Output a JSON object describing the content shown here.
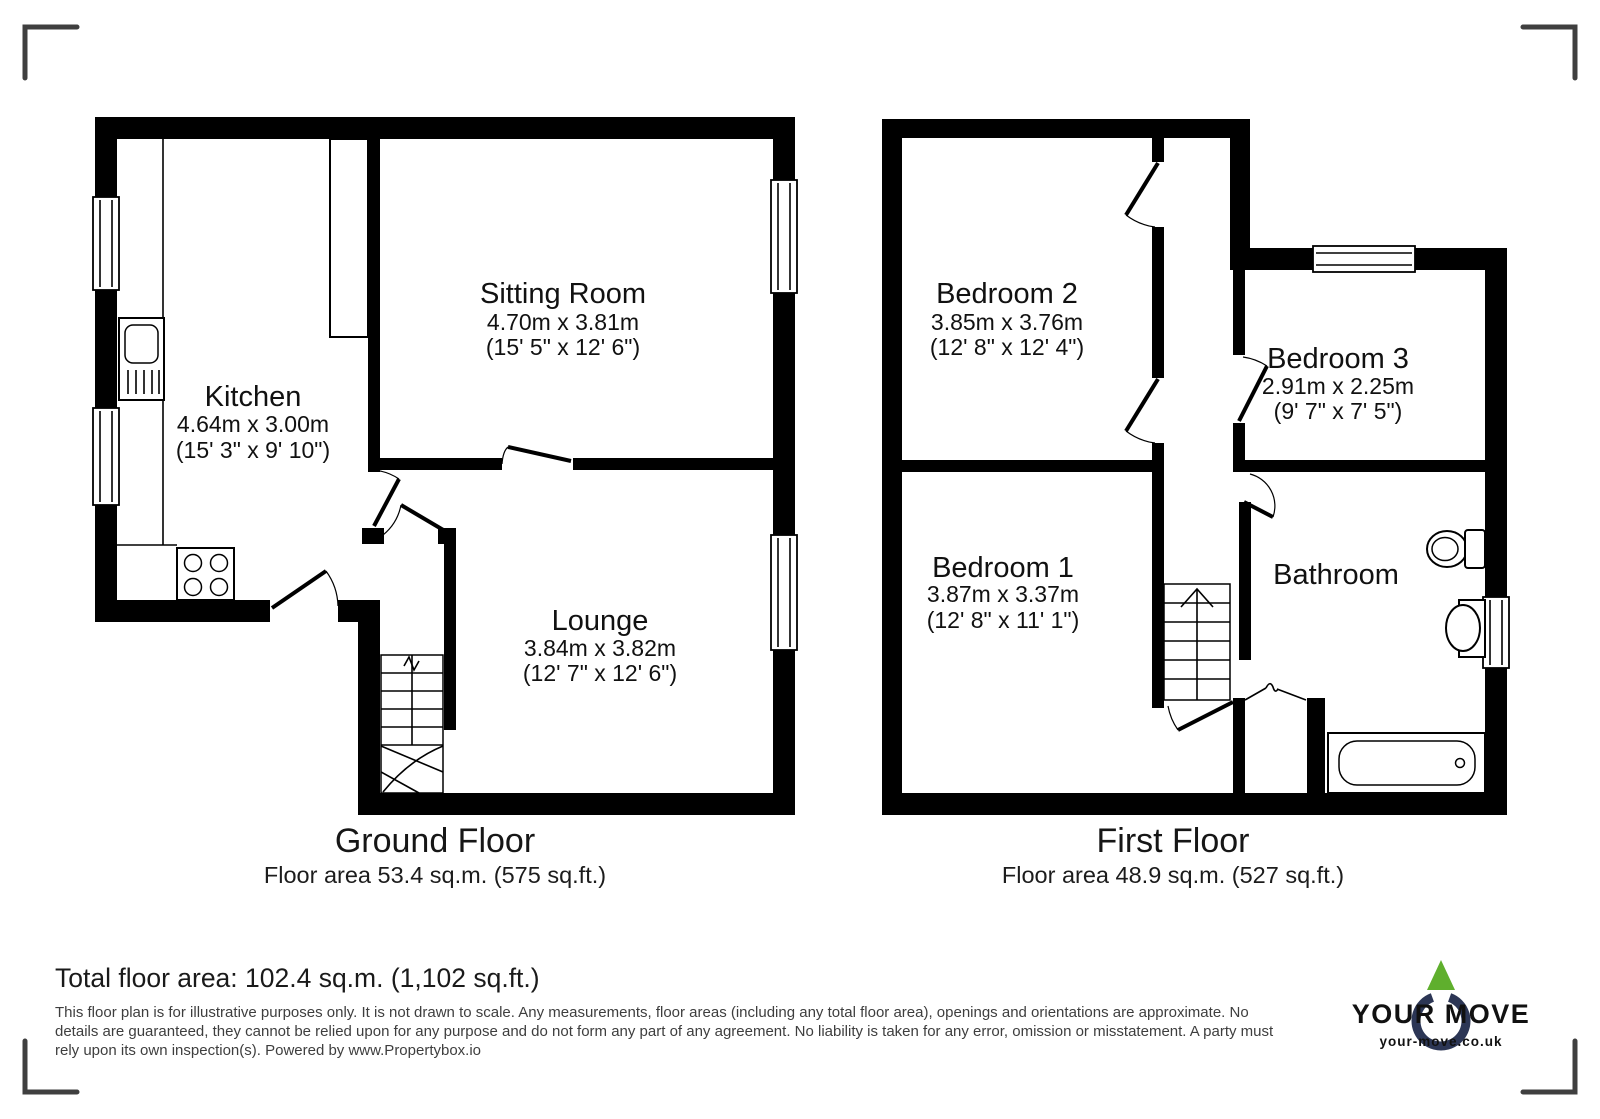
{
  "ground_floor": {
    "title": "Ground Floor",
    "area": "Floor area 53.4 sq.m. (575 sq.ft.)",
    "rooms": {
      "kitchen": {
        "name": "Kitchen",
        "metric": "4.64m x 3.00m",
        "imperial": "(15' 3\" x 9' 10\")"
      },
      "sitting_room": {
        "name": "Sitting Room",
        "metric": "4.70m x 3.81m",
        "imperial": "(15' 5\" x 12' 6\")"
      },
      "lounge": {
        "name": "Lounge",
        "metric": "3.84m x 3.82m",
        "imperial": "(12' 7\" x 12' 6\")"
      }
    }
  },
  "first_floor": {
    "title": "First Floor",
    "area": "Floor area 48.9 sq.m. (527 sq.ft.)",
    "rooms": {
      "bedroom_2": {
        "name": "Bedroom 2",
        "metric": "3.85m x 3.76m",
        "imperial": "(12' 8\" x 12' 4\")"
      },
      "bedroom_3": {
        "name": "Bedroom 3",
        "metric": "2.91m x 2.25m",
        "imperial": "(9' 7\" x 7' 5\")"
      },
      "bedroom_1": {
        "name": "Bedroom 1",
        "metric": "3.87m x 3.37m",
        "imperial": "(12' 8\" x 11' 1\")"
      },
      "bathroom": {
        "name": "Bathroom"
      }
    }
  },
  "footer": {
    "total_area": "Total floor area: 102.4 sq.m. (1,102 sq.ft.)",
    "disclaimer": "This floor plan is for illustrative purposes only. It is not drawn to scale. Any measurements, floor areas (including any total floor area), openings and orientations are approximate. No details are guaranteed, they cannot be relied upon for any purpose and do not form any part of any agreement. No liability is taken for any error, omission or misstatement. A party must rely upon its own inspection(s). Powered by www.Propertybox.io"
  },
  "logo": {
    "brand": "YOUR MOVE",
    "website": "your-move.co.uk",
    "colors": {
      "navy": "#2c3655",
      "green": "#5faf2d"
    }
  }
}
